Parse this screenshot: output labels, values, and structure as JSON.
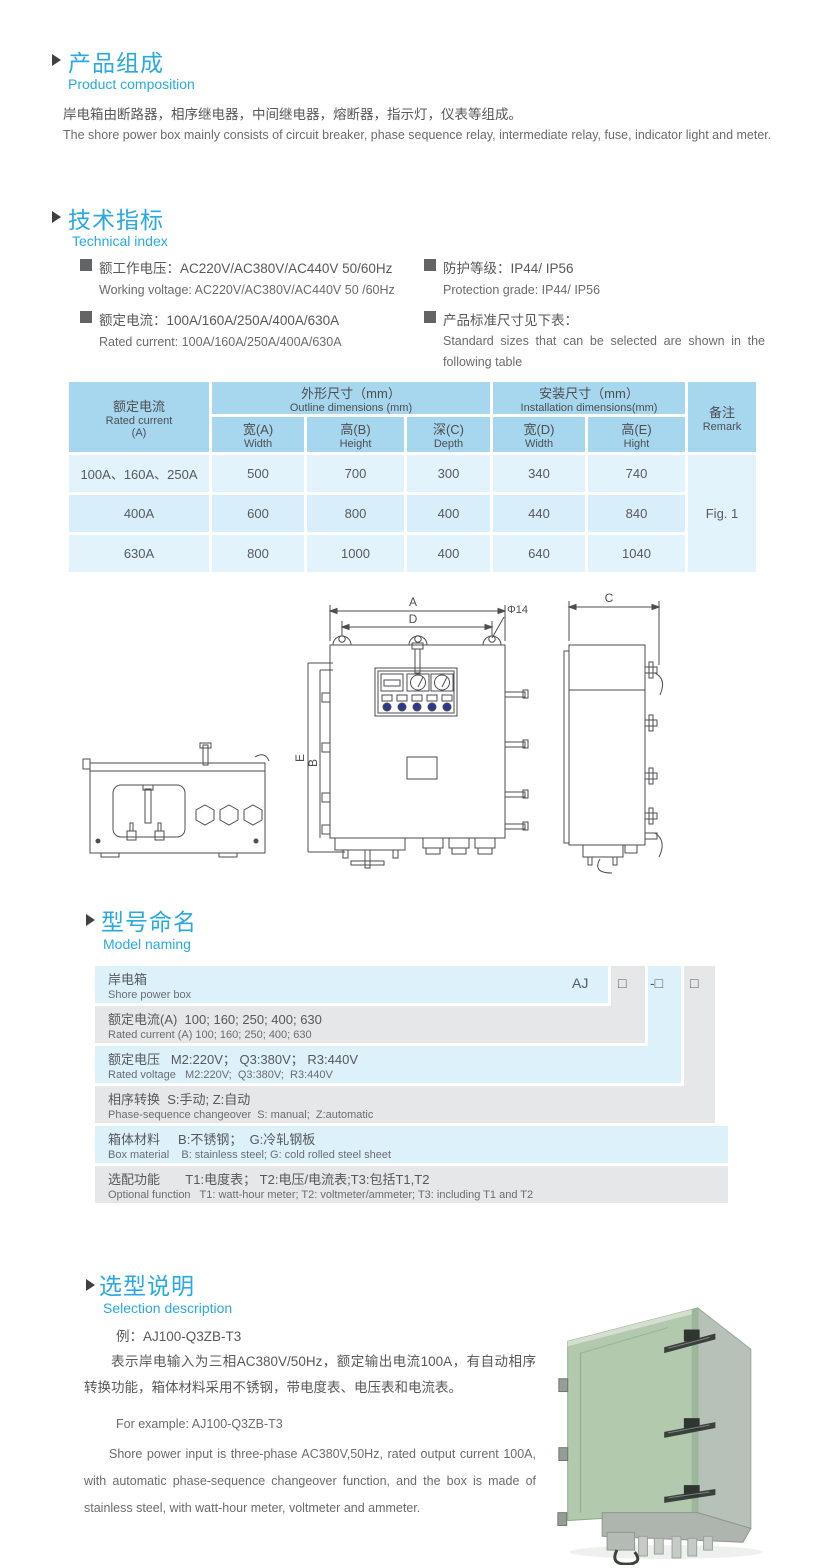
{
  "product": {
    "title_zh": "产品组成",
    "title_en": "Product  composition",
    "desc_zh": "岸电箱由断路器，相序继电器，中间继电器，熔断器，指示灯，仪表等组成。",
    "desc_en": "The shore power box mainly consists of circuit breaker, phase sequence relay, intermediate relay, fuse, indicator light and meter."
  },
  "technical": {
    "title_zh": "技术指标",
    "title_en": "Technical index",
    "specs": [
      {
        "zh": "额工作电压：AC220V/AC380V/AC440V  50/60Hz",
        "en": "Working voltage: AC220V/AC380V/AC440V 50 /60Hz"
      },
      {
        "zh": "额定电流：100A/160A/250A/400A/630A",
        "en": "Rated current: 100A/160A/250A/400A/630A"
      },
      {
        "zh": "防护等级：IP44/ IP56",
        "en": "Protection grade: IP44/ IP56"
      },
      {
        "zh": "产品标准尺寸见下表：",
        "en": "Standard sizes that can be selected are shown in the following table"
      }
    ]
  },
  "dim_table": {
    "rated_current_zh": "额定电流",
    "rated_current_en": "Rated current",
    "rated_current_unit": "(A)",
    "outline_zh": "外形尺寸（mm）",
    "outline_en": "Outline dimensions (mm)",
    "install_zh": "安装尺寸（mm）",
    "install_en": "Installation dimensions(mm)",
    "remark_zh": "备注",
    "remark_en": "Remark",
    "subcols": [
      {
        "zh": "宽(A)",
        "en": "Width"
      },
      {
        "zh": "高(B)",
        "en": "Height"
      },
      {
        "zh": "深(C)",
        "en": "Depth"
      },
      {
        "zh": "宽(D)",
        "en": "Width"
      },
      {
        "zh": "高(E)",
        "en": "Hight"
      }
    ],
    "rows": [
      {
        "label": "100A、160A、250A",
        "values": [
          "500",
          "700",
          "300",
          "340",
          "740"
        ]
      },
      {
        "label": "400A",
        "values": [
          "600",
          "800",
          "400",
          "440",
          "840"
        ]
      },
      {
        "label": "630A",
        "values": [
          "800",
          "1000",
          "400",
          "640",
          "1040"
        ]
      }
    ],
    "remark_value": "Fig. 1"
  },
  "drawing": {
    "dim_a": "A",
    "dim_d": "D",
    "dia_label": "Φ14",
    "dim_e": "E",
    "dim_b": "B",
    "dim_c": "C"
  },
  "model": {
    "title_zh": "型号命名",
    "title_en": "Model naming",
    "code": {
      "prefix": "AJ",
      "box1": "□",
      "box2": "-□",
      "box3": "□"
    },
    "rows": [
      {
        "zh": "岸电箱",
        "en": "Shore power box"
      },
      {
        "zh": "额定电流(A)  100; 160; 250; 400; 630",
        "en": "Rated current (A) 100; 160; 250; 400; 630"
      },
      {
        "zh": "额定电压   M2:220V； Q3:380V； R3:440V",
        "en": "Rated voltage   M2:220V;  Q3:380V;  R3:440V"
      },
      {
        "zh": "相序转换  S:手动; Z:自动",
        "en": "Phase-sequence changeover  S: manual;  Z:automatic"
      },
      {
        "zh": "箱体材料     B:不锈钢；  G:冷轧钢板",
        "en": "Box material    B: stainless steel; G: cold rolled steel sheet"
      },
      {
        "zh": "选配功能       T1:电度表； T2:电压/电流表;T3:包括T1,T2",
        "en": "Optional function   T1: watt-hour meter; T2: voltmeter/ammeter; T3: including T1 and T2"
      }
    ]
  },
  "selection": {
    "title_zh": "选型说明",
    "title_en": "Selection description",
    "example_zh": "例：AJ100-Q3ZB-T3",
    "para_zh": "表示岸电输入为三相AC380V/50Hz，额定输出电流100A，有自动相序转换功能，箱体材料采用不锈钢，带电度表、电压表和电流表。",
    "example_en": "For example: AJ100-Q3ZB-T3",
    "para_en": "Shore power input is three-phase AC380V,50Hz, rated output current 100A, with automatic phase-sequence changeover function, and the box is made of stainless steel, with watt-hour meter, voltmeter and ammeter."
  }
}
